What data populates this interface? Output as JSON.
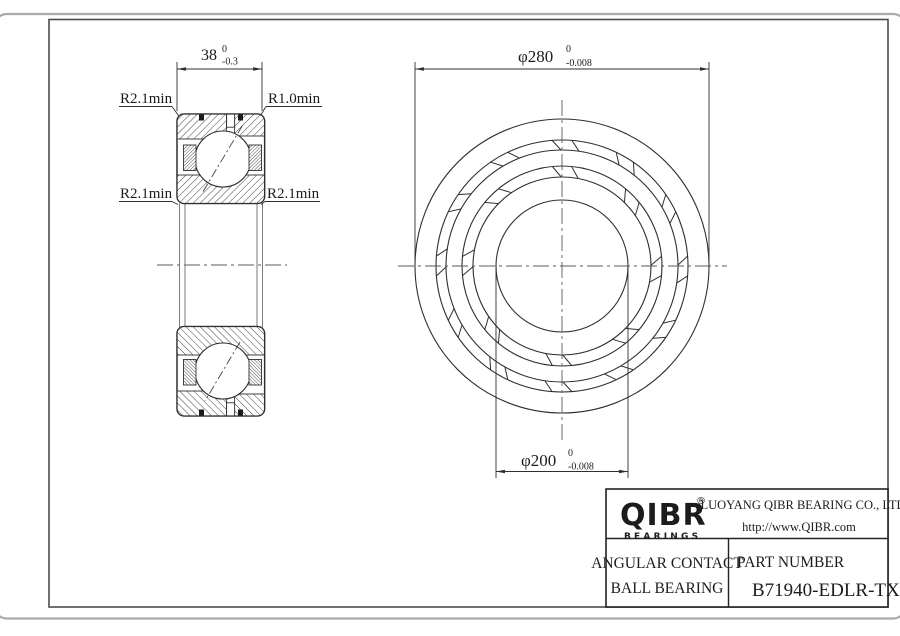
{
  "sheet": {
    "section_view": {
      "width_dim": {
        "main": "38",
        "tol_top": "0",
        "tol_bottom": "-0.3"
      },
      "label_top_left": "R2.1min",
      "label_top_right": "R1.0min",
      "label_mid_left": "R2.1min",
      "label_mid_right": "R2.1min"
    },
    "front_view": {
      "od_dim": {
        "main": "φ280",
        "tol_top": "0",
        "tol_bottom": "-0.008"
      },
      "bore_dim": {
        "main": "φ200",
        "tol_top": "0",
        "tol_bottom": "-0.008"
      }
    },
    "title_block": {
      "logo": "QIBR",
      "logo_registered": "®",
      "logo_subtitle": "BEARINGS",
      "company": "LUOYANG QIBR BEARING CO., LTD",
      "website": "http://www.QIBR.com",
      "product_line1": "ANGULAR CONTACT",
      "product_line2": "BALL BEARING",
      "part_number_label": "PART NUMBER",
      "part_number": "B71940-EDLR-TX-P2"
    }
  }
}
